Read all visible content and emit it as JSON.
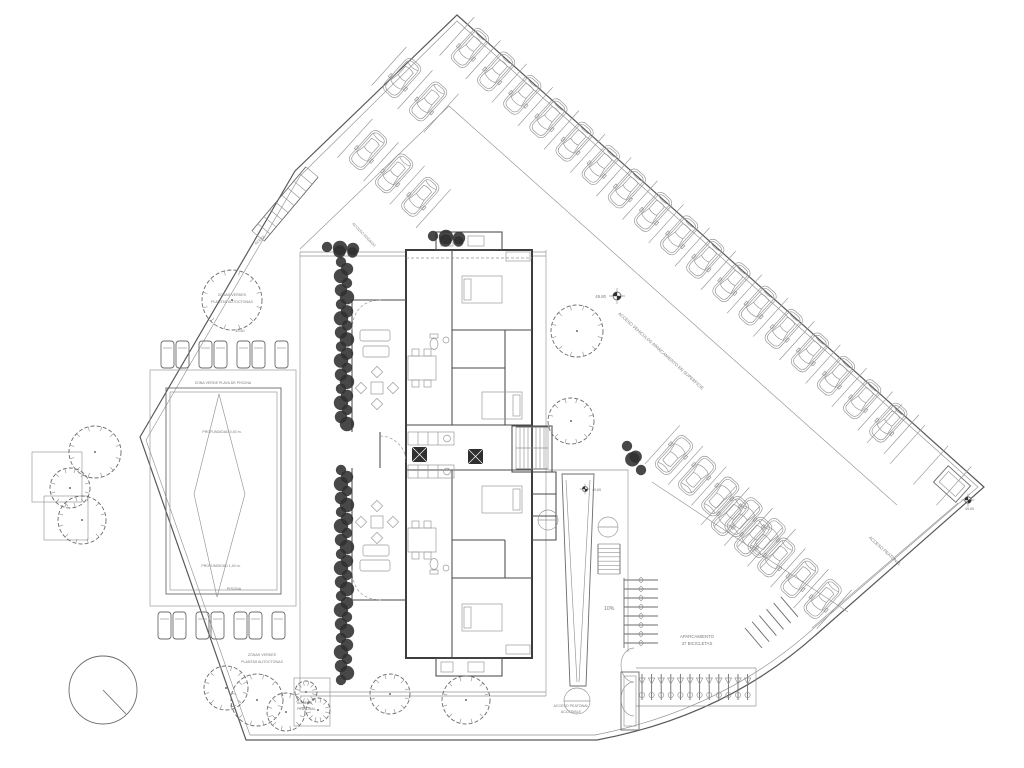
{
  "colors": {
    "background": "#ffffff",
    "line": "#6b6b6b",
    "wall": "#3d3d3d",
    "vegetation_dark": "#2f2f2f",
    "text": "#7a7a7a"
  },
  "site": {
    "green_zone_top": {
      "line1": "ZONAS VERDES",
      "line2": "PLANTAS AUTOCTONAS"
    },
    "green_zone_bottom": {
      "line1": "ZONAS VERDES",
      "line2": "PLANTAS AUTOCTONAS"
    },
    "sidewalk_label": "ACERA",
    "road_access_label": "ACCESO RODADO"
  },
  "pool": {
    "deck_label": "ZONA VERDE PLAYA DE PISCINA",
    "depth_shallow": "PROFUNDIDAD 0,40 m.",
    "depth_deep": "PROFUNDIDAD 1,40 m.",
    "name": "PISCINA",
    "sunloungers_top": 7,
    "sunloungers_bottom": 7
  },
  "parking": {
    "aisle_label": "ACCESO VEHICULOS APARCAMIENTO EN SUPERFICIE",
    "pedestrian_access_label": "ACCESO PEATONAL",
    "cars_top_right": 17,
    "cars_top_left_row1": 2,
    "cars_top_left_row2": 3,
    "cars_middle_row1": 5,
    "cars_middle_row2": 5,
    "empty_bays_right": 3
  },
  "bikes": {
    "label_line1": "APARCAMIENTO",
    "label_line2": "37 BICICLETAS",
    "row_count": 12,
    "diagonal_count": 6,
    "rack_teeth": 8
  },
  "ramp": {
    "slope_label": "10%"
  },
  "access": {
    "accessible_line1": "ACCESO PEATONAL",
    "accessible_line2": "ACCESIBLE",
    "small_line1": "ACCESO",
    "small_line2": "PEATONAL"
  },
  "elevations": {
    "spot_top_left": "49.80",
    "spot_center": "49.80",
    "spot_building": "49.65",
    "spot_right": "49.80"
  }
}
